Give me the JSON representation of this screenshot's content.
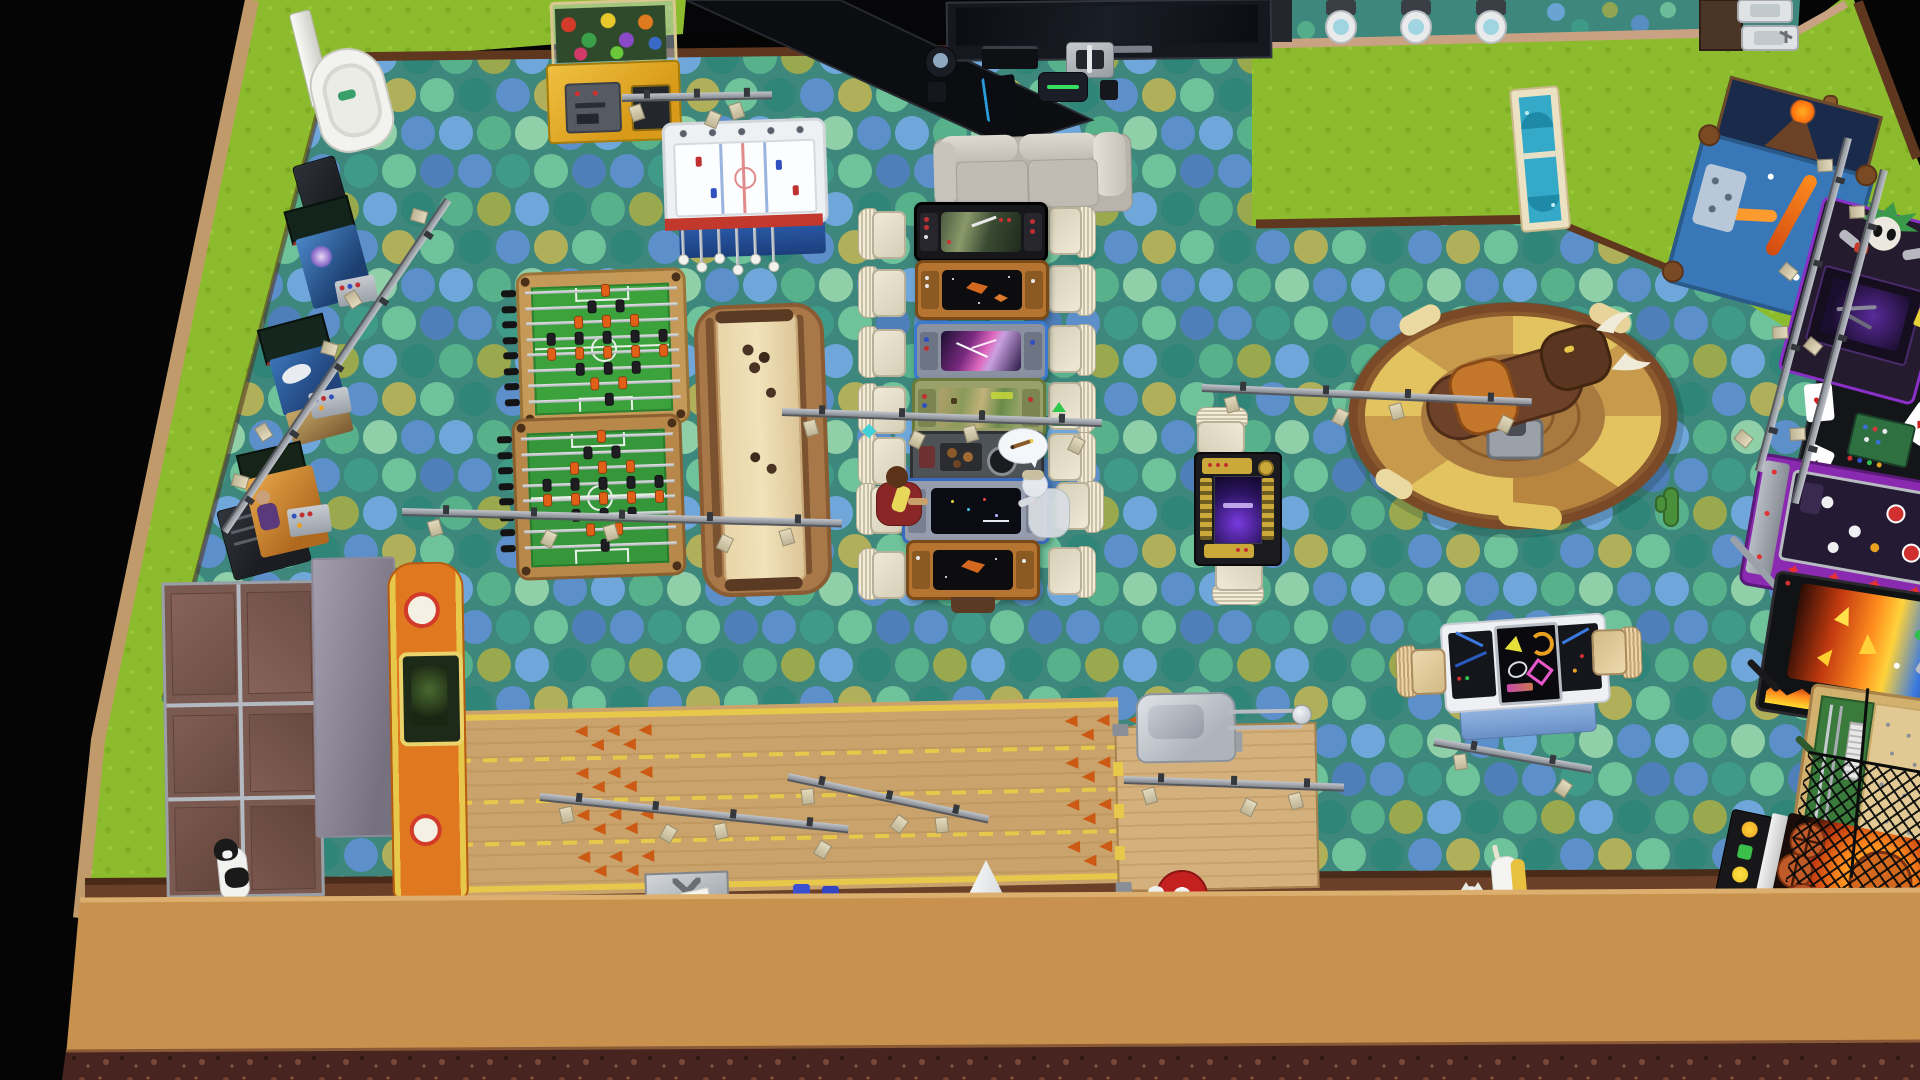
{
  "scene": {
    "game": "life-simulation game, top-down build view",
    "description": "Overhead view of an arcade and games venue with polka-dot carpet, bowling lane, foosball, shuffleboard, arcade gaming tables, a mechanical bull, pinball machines and a lawn border",
    "visible_text": []
  },
  "palette": {
    "outside_black": "#050505",
    "lawn_green": "#8dbb2e",
    "carpet_base": "#3e877c",
    "carpet_dots": [
      "#5d8fca",
      "#3f9b88",
      "#6fc39b",
      "#9aa84e",
      "#2f8577",
      "#6fa7db",
      "#8fd0a8",
      "#b0b05a"
    ],
    "wall_dark_brown": "#5f371f",
    "wall_tan": "#c9a183",
    "terrain_tan": "#c8924e",
    "terrain_soil": "#48241e",
    "lane_wood": "#c9a36b",
    "gutter_yellow": "#e8c84a",
    "bull_pad_brown": "#c89a4c",
    "bull_pad_yellow": "#e2c360"
  },
  "objects": {
    "capsule_machine": {
      "label": "White capsule vending machine"
    },
    "mini_cabinet": {
      "label": "Small dark arcade cabinet"
    },
    "arcade_blue_1": {
      "label": "Blue arcade cabinet - space game"
    },
    "arcade_blue_2": {
      "label": "Blue arcade cabinet - bird game"
    },
    "arcade_orange": {
      "label": "Orange arcade cabinet - boxer art"
    },
    "floor_speaker": {
      "label": "Dark floor speaker box"
    },
    "claw_machine": {
      "label": "Yellow claw machine full of prizes"
    },
    "bubble_hockey": {
      "label": "Bubble hockey table"
    },
    "dark_doorway": {
      "label": "Dark open doorway"
    },
    "tv": {
      "label": "Wall-mounted flat screen TV"
    },
    "speaker_ball": {
      "label": "Round speaker"
    },
    "game_console": {
      "label": "Game console"
    },
    "charging_dock": {
      "label": "Silver dock"
    },
    "mini_speaker": {
      "label": "Small speaker"
    },
    "tower_console": {
      "label": "Tower game console"
    },
    "vr_headset": {
      "label": "VR headset"
    },
    "couch": {
      "label": "Gray two-seat sofa"
    },
    "gaming_table_1": {
      "label": "Arcade gaming table - battle game"
    },
    "gaming_table_2": {
      "label": "Arcade gaming table - asteroids game"
    },
    "gaming_table_3": {
      "label": "Arcade gaming table - space shooter"
    },
    "gaming_table_4": {
      "label": "Arcade gaming table - fantasy game"
    },
    "gaming_table_5": {
      "label": "Gaming table with food"
    },
    "gaming_table_6": {
      "label": "Arcade gaming table - space battle, in use"
    },
    "gaming_table_7": {
      "label": "Arcade gaming table - asteroids game"
    },
    "chair": {
      "label": "White spindle chair"
    },
    "wooden_chair": {
      "label": "Light wood chair"
    },
    "sim_man": {
      "label": "Sim in dark red shirt playing gaming table"
    },
    "sim_ghost": {
      "label": "Pale ghost Sim playing gaming table"
    },
    "speech_bubble": {
      "label": "Speech bubble with pencil icon"
    },
    "foosball": {
      "label": "Foosball table"
    },
    "shuffleboard": {
      "label": "Shuffleboard table"
    },
    "pin_housing": {
      "label": "Bowling pinsetter housing with orange ramp"
    },
    "bowling_lanes": {
      "label": "Wooden bowling lanes with arrows"
    },
    "approach": {
      "label": "Bowling approach platform"
    },
    "ball_return": {
      "label": "Bowling ball return machine"
    },
    "neon_table": {
      "label": "Neon doodle gaming table"
    },
    "purple_table": {
      "label": "Black and gold gaming table with purple screen"
    },
    "mech_bull": {
      "label": "Mechanical bull ride with padded ring"
    },
    "cactus": {
      "label": "Cactus prop"
    },
    "volcano_pinball": {
      "label": "Volcano themed pinball machine"
    },
    "rocker_arcade": {
      "label": "Rocker arcade machine with painted figure"
    },
    "casino_machine": {
      "label": "Casino machine with giant dice and cards"
    },
    "star_pinball": {
      "label": "Purple pinball machine with red stars"
    },
    "fire_pinball": {
      "label": "Flame themed pinball machine"
    },
    "wood_pinball": {
      "label": "Vintage wooden pachinko table"
    },
    "basketball_game": {
      "label": "Basketball arcade machine with net"
    },
    "track_light": {
      "label": "Track lighting bar"
    },
    "toilet": {
      "label": "Toilet"
    },
    "sink": {
      "label": "Bathroom sink"
    },
    "bath_cabinet": {
      "label": "Bathroom cabinet"
    },
    "glass_door": {
      "label": "Cream framed glass door"
    },
    "wood_post": {
      "label": "Wooden post"
    },
    "cat_bw": {
      "label": "Black and white cat"
    },
    "cat_white": {
      "label": "White cat"
    },
    "pale_horse": {
      "label": "White animal with blonde mane"
    },
    "sim_red": {
      "label": "Sim in red with white hat seen from above"
    },
    "metal_sign": {
      "label": "Metal sign"
    },
    "blue_cups": {
      "label": "Blue cups"
    },
    "pencil": {
      "label": "Pencil prop"
    },
    "paper_cone": {
      "label": "White paper cone"
    },
    "papers": {
      "label": "Scattered papers"
    }
  }
}
